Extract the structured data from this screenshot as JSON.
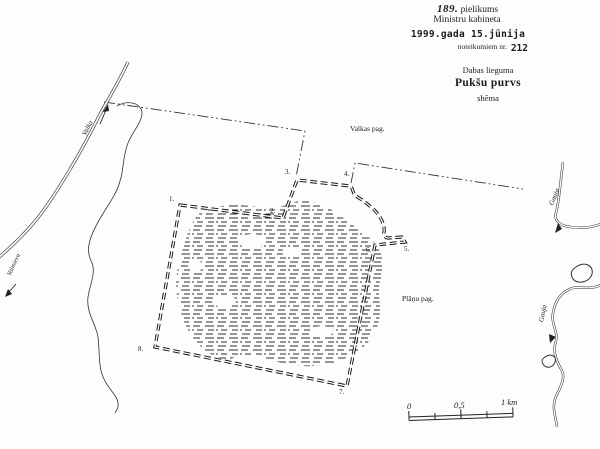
{
  "colors": {
    "ink": "#1c1c1c",
    "paper": "#fdfdfb"
  },
  "header": {
    "annex_no": "189.",
    "annex_word": "pielikums",
    "cabinet": "Ministru kabineta",
    "date_line": "1999.gada 15.jūnija",
    "regulation_prefix": "noteikumiem nr.",
    "regulation_no": "212",
    "category": "Dabas lieguma",
    "title": "Pukšu purvs",
    "doc_type": "shēma"
  },
  "map": {
    "parishes": [
      {
        "name": "Valkas pag."
      },
      {
        "name": "Plāņu pag."
      }
    ],
    "road": {
      "name": "Valka",
      "direction": "Valmiera"
    },
    "rivers": [
      {
        "name": "Gauja"
      },
      {
        "name": "Gauja"
      }
    ],
    "boundary_points": [
      {
        "label": "1."
      },
      {
        "label": "2."
      },
      {
        "label": "3."
      },
      {
        "label": "4."
      },
      {
        "label": "5."
      },
      {
        "label": "6."
      },
      {
        "label": "7."
      },
      {
        "label": "8."
      }
    ]
  },
  "scale_bar": {
    "start": "0",
    "middle": "0,5",
    "end": "1 km"
  }
}
